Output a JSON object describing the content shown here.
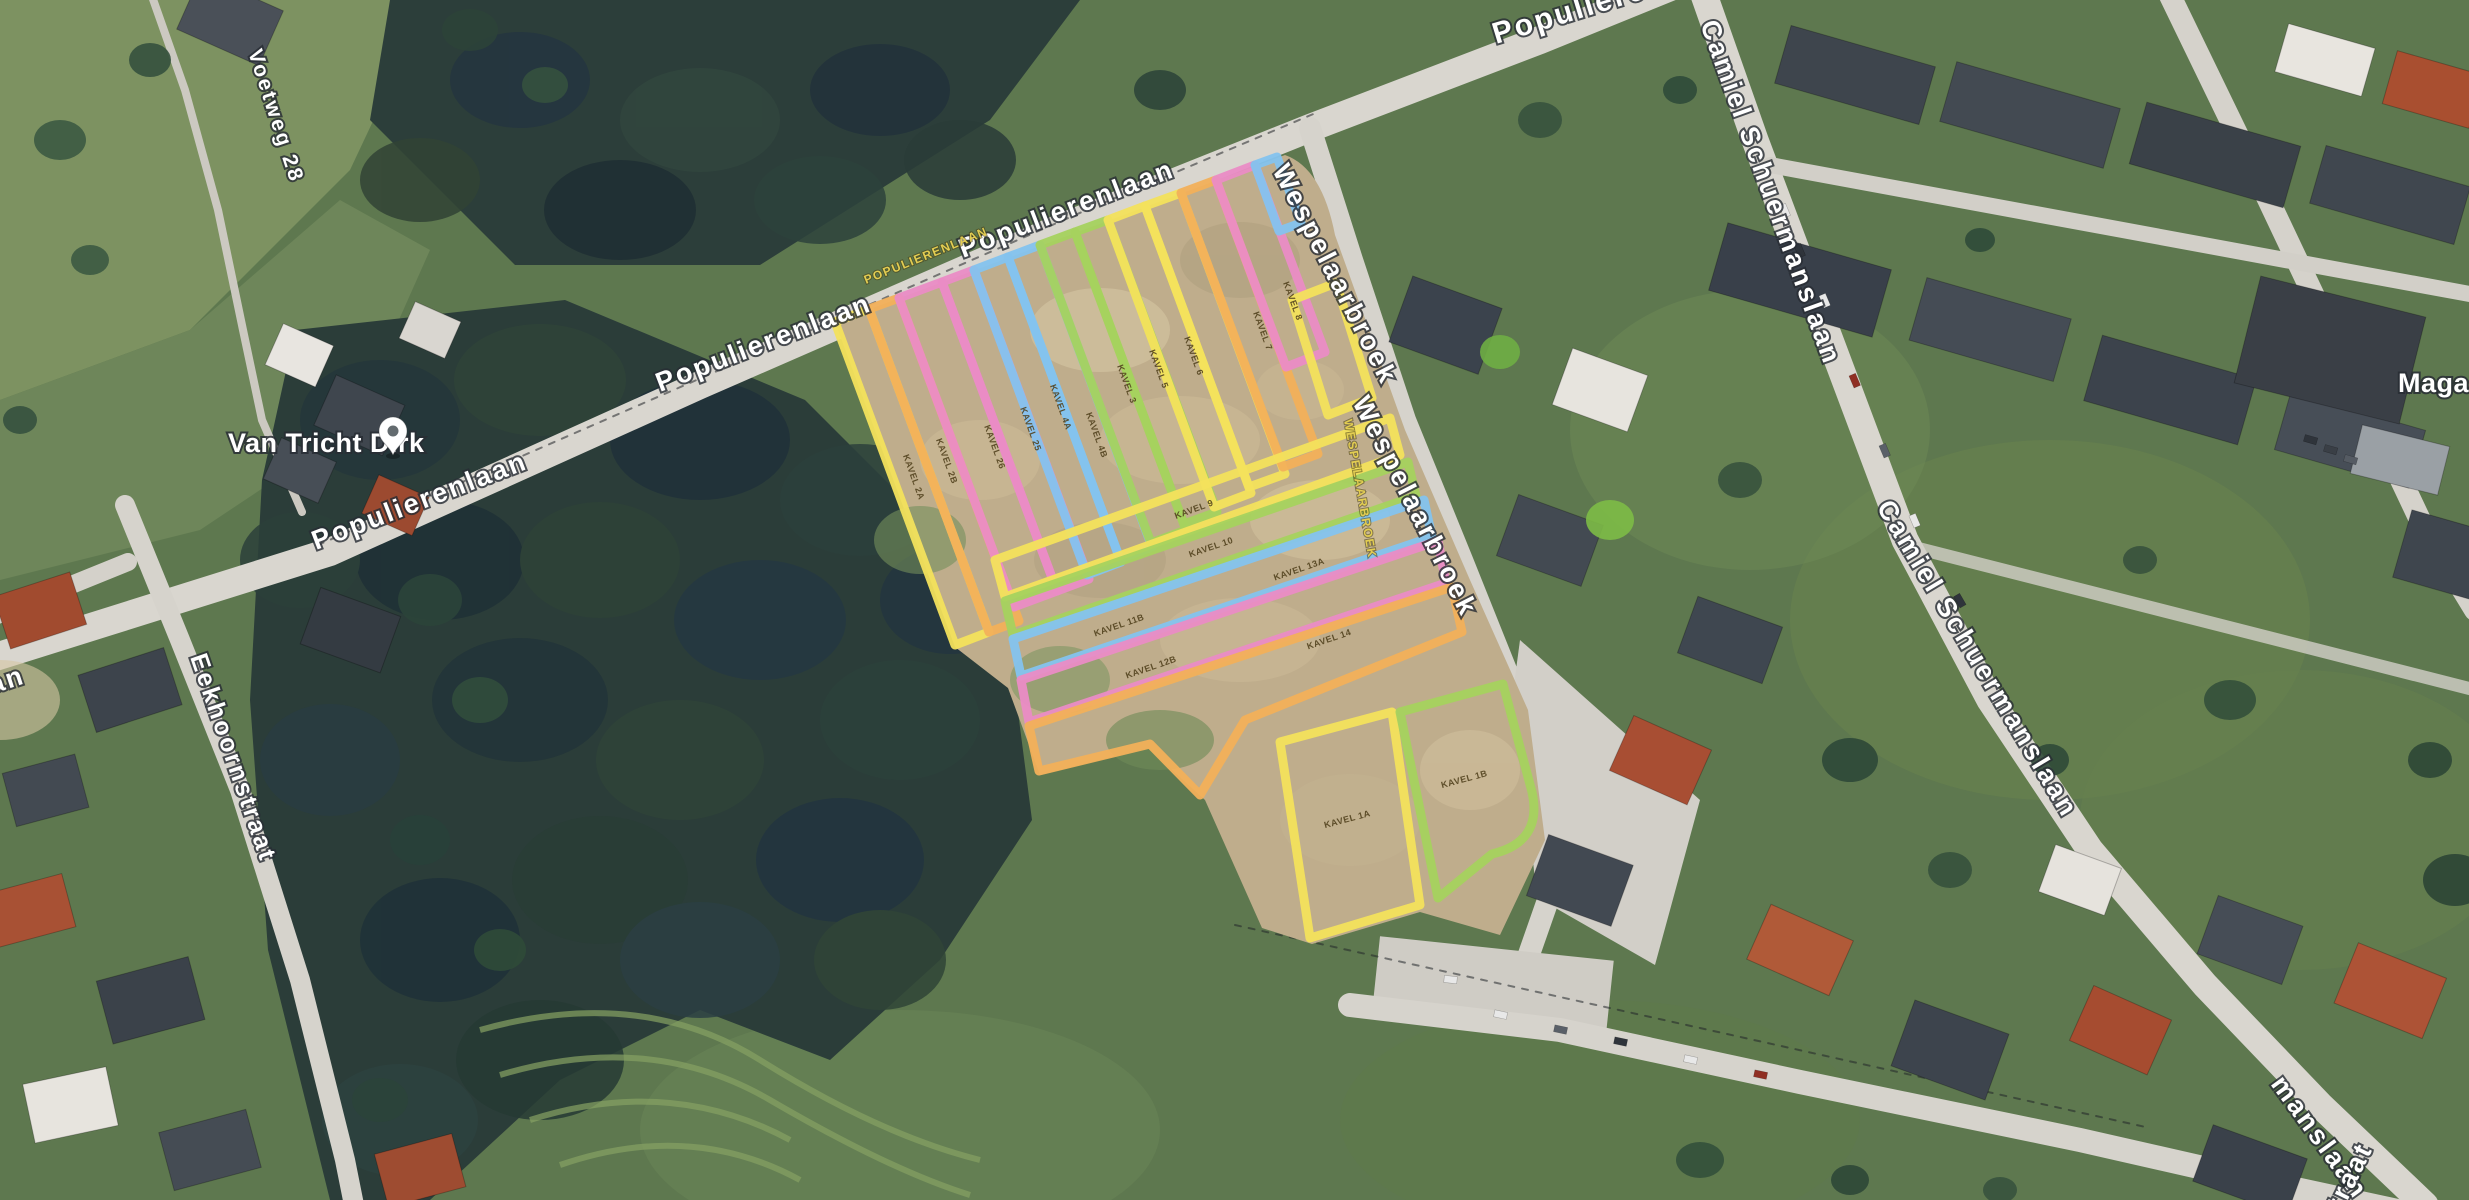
{
  "map_type": "satellite",
  "streets": {
    "populierenlaan": "Populierenlaan",
    "populierenlaan_caps": "POPULIERENLAAN",
    "wespelaarbroek": "Wespelaarbroek",
    "wespelaarbroek_caps": "WESPELAARBROEK",
    "camiel_schuermanslaan": "Camiel Schuermanslaan",
    "camiel_partial": "manslaan",
    "eekhoornstraat": "Eekhoornstraat",
    "voetweg_28": "Voetweg 28",
    "left_edge_partial": "an",
    "bottom_edge_partial": "traat"
  },
  "pois": {
    "van_tricht_dirk": "Van Tricht Dirk",
    "magasin_partial": "Magasin"
  },
  "parcels": {
    "colors": {
      "yellow": "#f3e25c",
      "orange": "#f2b05a",
      "pink": "#ea8cc5",
      "blue": "#84c3ee",
      "green": "#a5d25e"
    },
    "labels": [
      {
        "text": "KAVEL 2A",
        "color": "yellow"
      },
      {
        "text": "KAVEL 2B",
        "color": "orange"
      },
      {
        "text": "KAVEL 26",
        "color": "pink"
      },
      {
        "text": "KAVEL 25",
        "color": "pink"
      },
      {
        "text": "KAVEL 4A",
        "color": "blue"
      },
      {
        "text": "KAVEL 4B",
        "color": "blue"
      },
      {
        "text": "KAVEL 3",
        "color": "green"
      },
      {
        "text": "KAVEL 5",
        "color": "green"
      },
      {
        "text": "KAVEL 6",
        "color": "yellow"
      },
      {
        "text": "KAVEL 7",
        "color": "orange"
      },
      {
        "text": "KAVEL 8",
        "color": "pink"
      },
      {
        "text": "KAVEL 9",
        "color": "yellow"
      },
      {
        "text": "KAVEL 10",
        "color": "green"
      },
      {
        "text": "KAVEL 11B",
        "color": "blue"
      },
      {
        "text": "KAVEL 13A",
        "color": "blue"
      },
      {
        "text": "KAVEL 12B",
        "color": "pink"
      },
      {
        "text": "KAVEL 14",
        "color": "orange"
      },
      {
        "text": "KAVEL 1A",
        "color": "yellow"
      },
      {
        "text": "KAVEL 1B",
        "color": "green"
      }
    ]
  }
}
